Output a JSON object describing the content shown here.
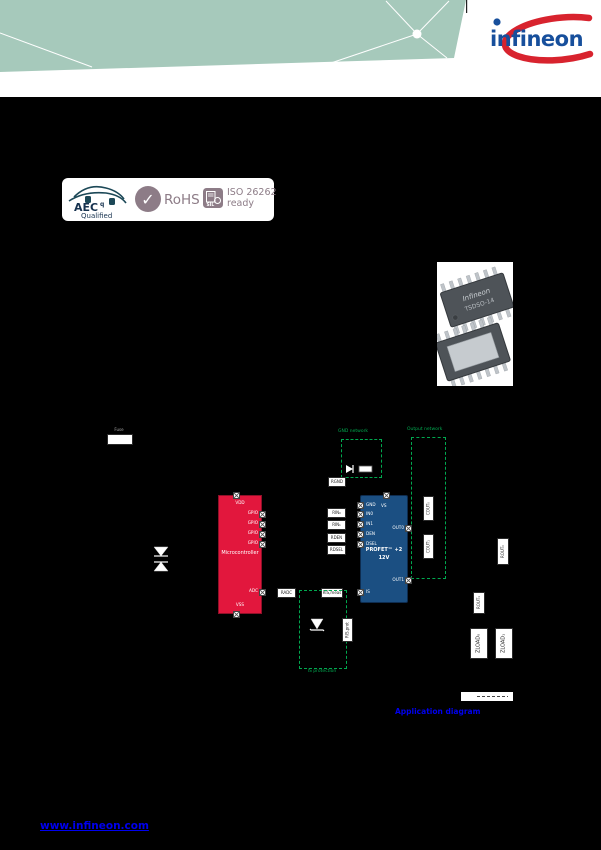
{
  "colors": {
    "teal": "#A6C9BB",
    "logo_blue": "#174F9C",
    "logo_red": "#D8232E",
    "mauve": "#8D7C87",
    "aec_navy": "#1C4857",
    "mcu_red": "#E2173D",
    "mcu_red_dark": "#8F1028",
    "profet_blue": "#1B4F82",
    "profet_blue_dark": "#0E2C4F",
    "green": "#00A84F",
    "link": "#0000EE",
    "chip_gray": "#4E5358",
    "pin_silver": "#BFC4C9"
  },
  "logo": {
    "text": "infineon"
  },
  "badges": {
    "aec_top": "AEC",
    "aec_sup": "q",
    "aec_bottom": "Qualified",
    "check": "✓",
    "rohs": "RoHS",
    "sil": "SIL",
    "iso_line1": "ISO 26262",
    "iso_line2": "ready"
  },
  "package": {
    "brand": "Infineon",
    "name": "TSDSO-14"
  },
  "schematic": {
    "fuse": "Fuse",
    "mcu": {
      "title": "Microcontroller",
      "vdd": "VDD",
      "gpio": "GPIO",
      "adc": "ADC",
      "vss": "VSS"
    },
    "profet": {
      "line1": "PROFET™ +2",
      "line2": "12V",
      "gnd": "GND",
      "vs": "VS",
      "in0": "IN0",
      "in1": "IN1",
      "den": "DEN",
      "dsel": "DSEL",
      "is": "IS",
      "out0": "OUT0",
      "out1": "OUT1"
    },
    "resistors": {
      "gnd": "RGND",
      "in0": "RIN₀",
      "in1": "RIN₁",
      "den": "RDEN",
      "dsel": "RDSEL",
      "adc": "RADC",
      "is_meas": "RIS,meas",
      "is_prot": "RIS,prot",
      "out0": "COUT₀",
      "out1": "COUT₁",
      "ser0": "ROUT₀",
      "ser1": "ROUT₁"
    },
    "loads": {
      "l0": "ZLOAD₀",
      "l1": "ZLOAD₁"
    },
    "captions": {
      "gnd_box": "GND network",
      "out_box": "Output network",
      "is_box": "IS protection"
    }
  },
  "page": {
    "figure_caption": "Application diagram",
    "footer_link": "www.infineon.com"
  }
}
